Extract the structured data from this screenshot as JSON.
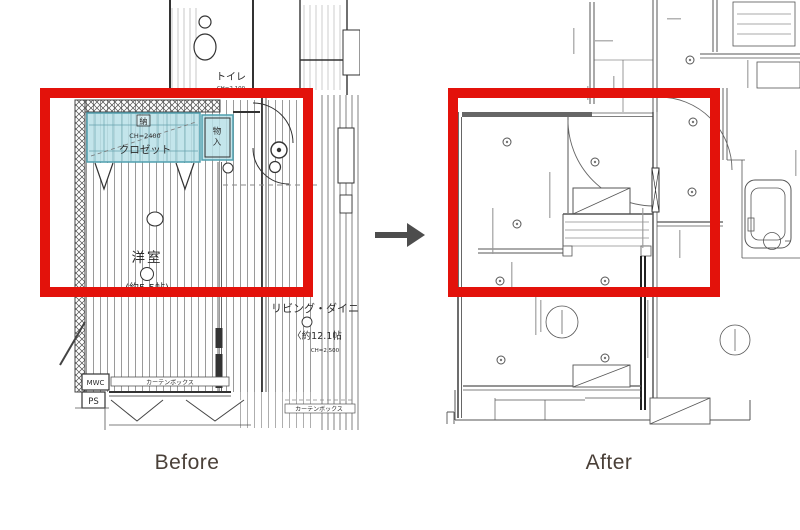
{
  "comparison": {
    "before_caption": "Before",
    "after_caption": "After",
    "annotation_box_color": "#e3120b",
    "arrow_color": "#4d4d4d"
  },
  "before": {
    "label": "Before",
    "plan": {
      "highlight_color": "#b9e0e8",
      "labels": {
        "toilet": "トイレ",
        "toilet_ch": "CH=2,100",
        "closet_tag": "納",
        "closet_ch": "CH=2400",
        "closet": "クロゼット",
        "storage_1": "物",
        "storage_2": "入",
        "room": "洋室",
        "room_size": "(約5.5帖)",
        "living": "リビング・ダイニン",
        "living_size": "〈約12.1帖",
        "living_ch": "CH=2,500",
        "mwc": "MWC",
        "curtain_box": "カーテンボックス",
        "ps": "PS",
        "curtain_box2": "カーテンボックス"
      }
    }
  },
  "after": {
    "label": "After"
  }
}
